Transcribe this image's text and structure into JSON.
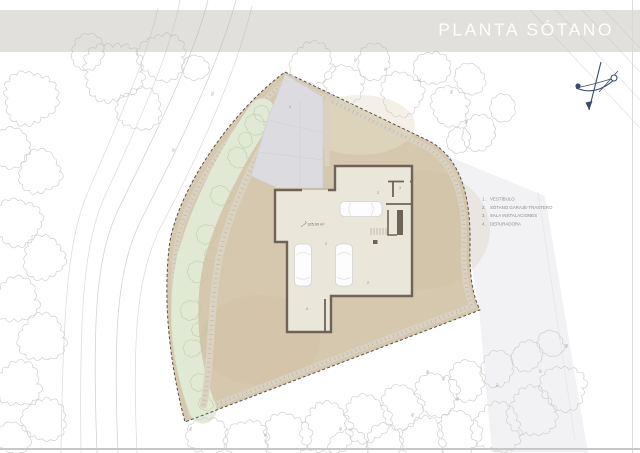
{
  "title": {
    "text": "PLANTA SÓTANO"
  },
  "legend": {
    "items": [
      {
        "n": "1.",
        "label": "VESTÍBULO"
      },
      {
        "n": "2.",
        "label": "SÓTANO GARAJE-TRASTERO"
      },
      {
        "n": "3.",
        "label": "SALA INSTALACIONES"
      },
      {
        "n": "4.",
        "label": "DEPURADORA"
      }
    ]
  },
  "plan": {
    "area_label": "325.00 m²",
    "room_markers": [
      {
        "x": 289,
        "y": 108,
        "t": "1"
      },
      {
        "x": 377,
        "y": 194,
        "t": "2"
      },
      {
        "x": 399,
        "y": 189,
        "t": "3"
      },
      {
        "x": 325,
        "y": 245,
        "t": "2"
      },
      {
        "x": 367,
        "y": 284,
        "t": "2"
      },
      {
        "x": 306,
        "y": 310,
        "t": "4"
      }
    ],
    "elevation_labels": [
      {
        "x": 356,
        "y": 62,
        "t": "92"
      },
      {
        "x": 386,
        "y": 71,
        "t": "91"
      },
      {
        "x": 420,
        "y": 82,
        "t": "91"
      },
      {
        "x": 452,
        "y": 94,
        "t": "90"
      },
      {
        "x": 467,
        "y": 124,
        "t": "90"
      },
      {
        "x": 213,
        "y": 96,
        "t": "93"
      },
      {
        "x": 174,
        "y": 152,
        "t": "92"
      },
      {
        "x": 191,
        "y": 431,
        "t": "84"
      },
      {
        "x": 266,
        "y": 437,
        "t": "85"
      },
      {
        "x": 341,
        "y": 431,
        "t": "85"
      },
      {
        "x": 413,
        "y": 417,
        "t": "86"
      },
      {
        "x": 428,
        "y": 374,
        "t": "86"
      },
      {
        "x": 444,
        "y": 381,
        "t": "86"
      },
      {
        "x": 458,
        "y": 401,
        "t": "86"
      },
      {
        "x": 498,
        "y": 387,
        "t": "87"
      },
      {
        "x": 541,
        "y": 373,
        "t": "87"
      },
      {
        "x": 567,
        "y": 348,
        "t": "88"
      }
    ],
    "trees": [
      [
        30,
        98,
        26
      ],
      [
        12,
        148,
        19
      ],
      [
        40,
        172,
        21
      ],
      [
        18,
        222,
        23
      ],
      [
        44,
        258,
        21
      ],
      [
        16,
        300,
        22
      ],
      [
        42,
        338,
        23
      ],
      [
        18,
        384,
        22
      ],
      [
        44,
        420,
        21
      ],
      [
        14,
        438,
        16
      ],
      [
        113,
        72,
        29
      ],
      [
        162,
        57,
        23
      ],
      [
        139,
        109,
        21
      ],
      [
        88,
        52,
        17
      ],
      [
        196,
        68,
        13
      ],
      [
        312,
        64,
        21
      ],
      [
        344,
        84,
        19
      ],
      [
        374,
        62,
        17
      ],
      [
        402,
        94,
        21
      ],
      [
        432,
        68,
        17
      ],
      [
        450,
        106,
        19
      ],
      [
        470,
        79,
        15
      ],
      [
        479,
        133,
        17
      ],
      [
        502,
        108,
        13
      ],
      [
        458,
        140,
        12
      ],
      [
        207,
        436,
        19
      ],
      [
        247,
        441,
        21
      ],
      [
        287,
        437,
        23
      ],
      [
        327,
        429,
        25
      ],
      [
        367,
        419,
        23
      ],
      [
        402,
        407,
        21
      ],
      [
        437,
        394,
        21
      ],
      [
        467,
        381,
        19
      ],
      [
        497,
        369,
        17
      ],
      [
        527,
        356,
        15
      ],
      [
        551,
        344,
        13
      ],
      [
        563,
        388,
        22
      ],
      [
        532,
        412,
        24
      ],
      [
        497,
        428,
        24
      ],
      [
        459,
        434,
        22
      ],
      [
        423,
        439,
        21
      ],
      [
        385,
        444,
        19
      ],
      [
        348,
        447,
        18
      ]
    ],
    "green_scribbles": [
      [
        255,
        125,
        10
      ],
      [
        238,
        158,
        10
      ],
      [
        221,
        196,
        10
      ],
      [
        207,
        234,
        10
      ],
      [
        197,
        272,
        10
      ],
      [
        191,
        310,
        10
      ],
      [
        193,
        348,
        9
      ],
      [
        200,
        382,
        9
      ],
      [
        206,
        404,
        7
      ],
      [
        245,
        140,
        7
      ],
      [
        212,
        255,
        7
      ],
      [
        199,
        330,
        7
      ],
      [
        262,
        114,
        8
      ]
    ],
    "colors": {
      "terrain": "#d6c8ae",
      "terrain_shade": "#c9b795",
      "building_wall": "#6e6355",
      "building_floor": "#eae7da",
      "greenery_fill": "#e1ebd6",
      "greenery_stroke": "#b6cba4",
      "gravel_band": "#d9d1c1",
      "gravel_dots": "#b2a68b",
      "driveway": "#dcdce0",
      "boundary_dash": "#55504a",
      "tree_outline": "#cfcfcd",
      "contour_line": "#dedede",
      "panel": "#f2f2f4",
      "legend_text": "#8a8a8a",
      "marker_text": "#8b8378",
      "north_arrow": "#3b4a72",
      "car_outline": "#d2d2d2"
    }
  }
}
